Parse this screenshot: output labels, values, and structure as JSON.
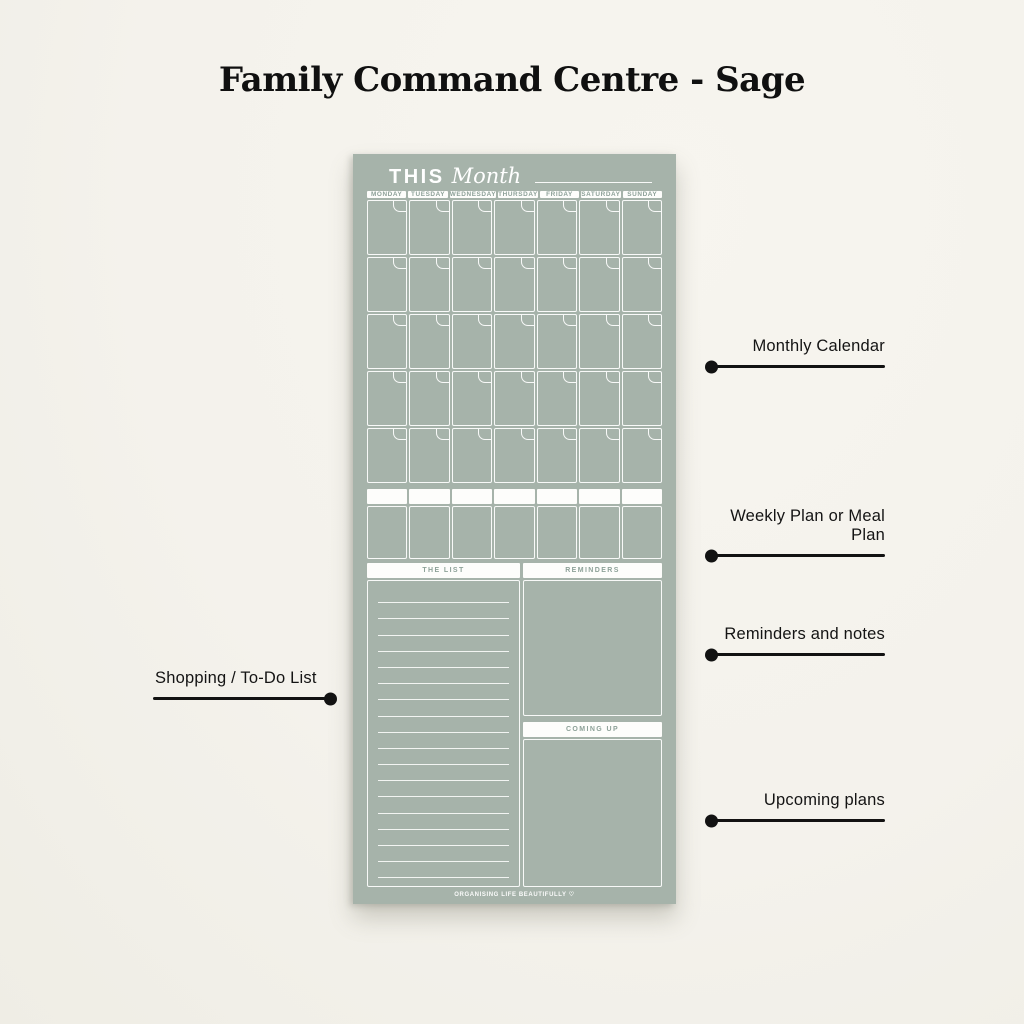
{
  "title": "Family Command Centre - Sage",
  "colors": {
    "background": "#f4f2ec",
    "board_sage": "#a6b3aa",
    "header_text_sage": "#8da198",
    "white": "#fdfdfb",
    "annotation_ink": "#121212"
  },
  "planner": {
    "header": {
      "bold": "THIS",
      "script": "Month"
    },
    "days": [
      "MONDAY",
      "TUESDAY",
      "WEDNESDAY",
      "THURSDAY",
      "FRIDAY",
      "SATURDAY",
      "SUNDAY"
    ],
    "calendar": {
      "rows": 5,
      "cols": 7
    },
    "weekly": {
      "cols": 7
    },
    "sections": {
      "list": "THE LIST",
      "reminders": "REMINDERS",
      "coming_up": "COMING UP"
    },
    "list": {
      "line_count": 18
    },
    "footer_logo": "Organising life Beautifully ♡"
  },
  "annotations": {
    "right": [
      {
        "label": "Monthly Calendar"
      },
      {
        "label": "Weekly Plan or Meal Plan"
      },
      {
        "label": "Reminders and notes"
      },
      {
        "label": "Upcoming plans"
      }
    ],
    "left": [
      {
        "label": "Shopping / To-Do List"
      }
    ]
  }
}
